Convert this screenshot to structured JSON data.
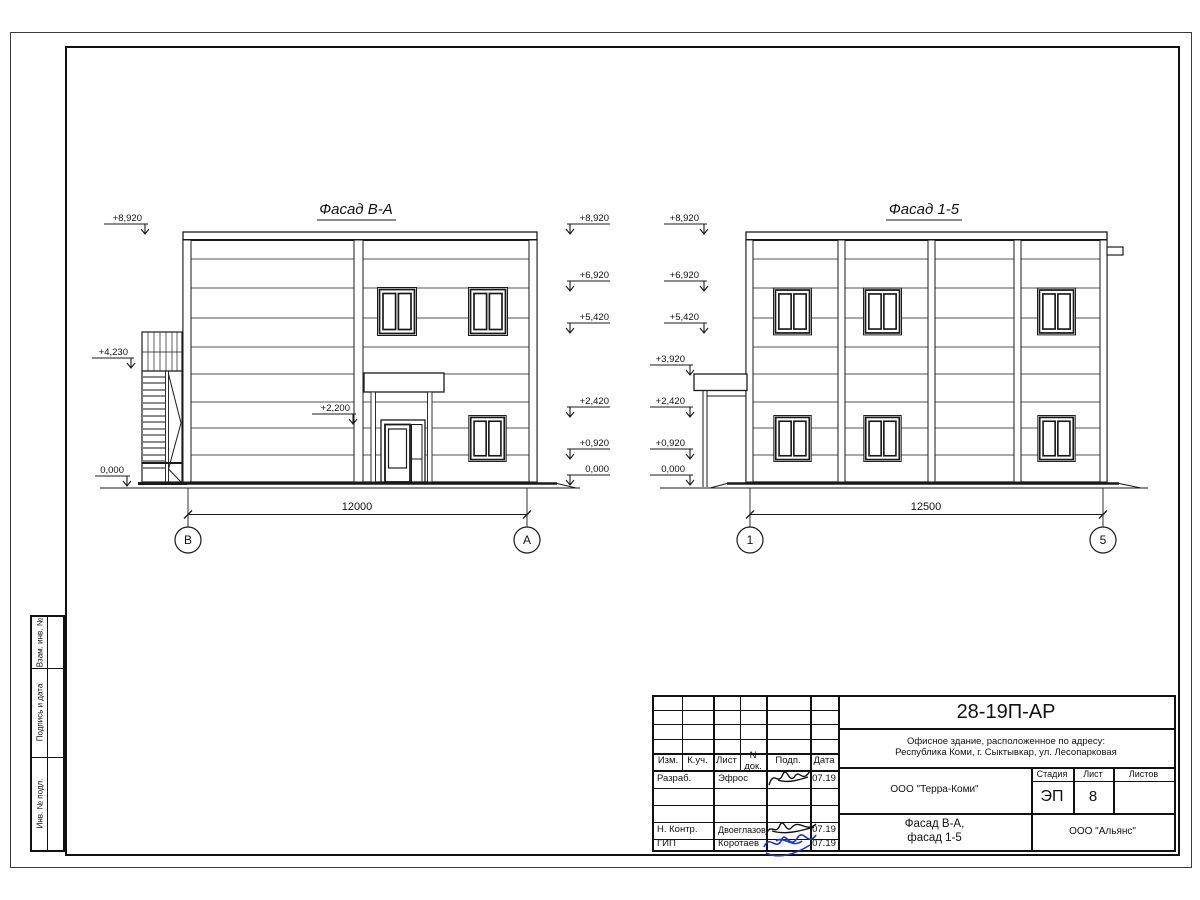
{
  "drawings": {
    "facade_ba": {
      "title": "Фасад В-А",
      "dimension": "12000",
      "axis_left": "В",
      "axis_right": "А",
      "marks_left": [
        "+8,920",
        "+4,230",
        "0,000"
      ],
      "mark_entry": "+2,200",
      "marks_right": [
        "+8,920",
        "+6,920",
        "+5,420",
        "+2,420",
        "+0,920",
        "0,000"
      ]
    },
    "facade_15": {
      "title": "Фасад 1-5",
      "dimension": "12500",
      "axis_left": "1",
      "axis_right": "5",
      "marks_left": [
        "+8,920",
        "+6,920",
        "+5,420",
        "+3,920",
        "+2,420",
        "+0,920",
        "0,000"
      ]
    }
  },
  "title_block": {
    "code": "28-19П-АР",
    "object_line1": "Офисное здание, расположенное по адресу:",
    "object_line2": "Республика Коми, г. Сыктывкар, ул. Лесопарковая",
    "company": "ООО \"Терра-Коми\"",
    "stage_label": "Стадия",
    "sheet_label": "Лист",
    "sheets_label": "Листов",
    "stage": "ЭП",
    "sheet_no": "8",
    "sheets_total": "",
    "drawing_name_line1": "Фасад В-А,",
    "drawing_name_line2": "фасад 1-5",
    "contractor": "ООО \"Альянс\"",
    "header": {
      "izm": "Изм.",
      "kuch": "К.уч.",
      "list": "Лист",
      "ndok": "N док.",
      "podp": "Подп.",
      "data": "Дата"
    },
    "rows": [
      {
        "role": "Разраб.",
        "name": "Эфрос",
        "date": "07.19"
      },
      {
        "role": "Н. Контр.",
        "name": "Двоеглазов",
        "date": "07.19"
      },
      {
        "role": "ГИП",
        "name": "Коротаев",
        "date": "07.19"
      }
    ]
  },
  "side_strip": {
    "cells": [
      "Взам. инв. №",
      "Подпись и дата",
      "Инв. № подл."
    ]
  }
}
